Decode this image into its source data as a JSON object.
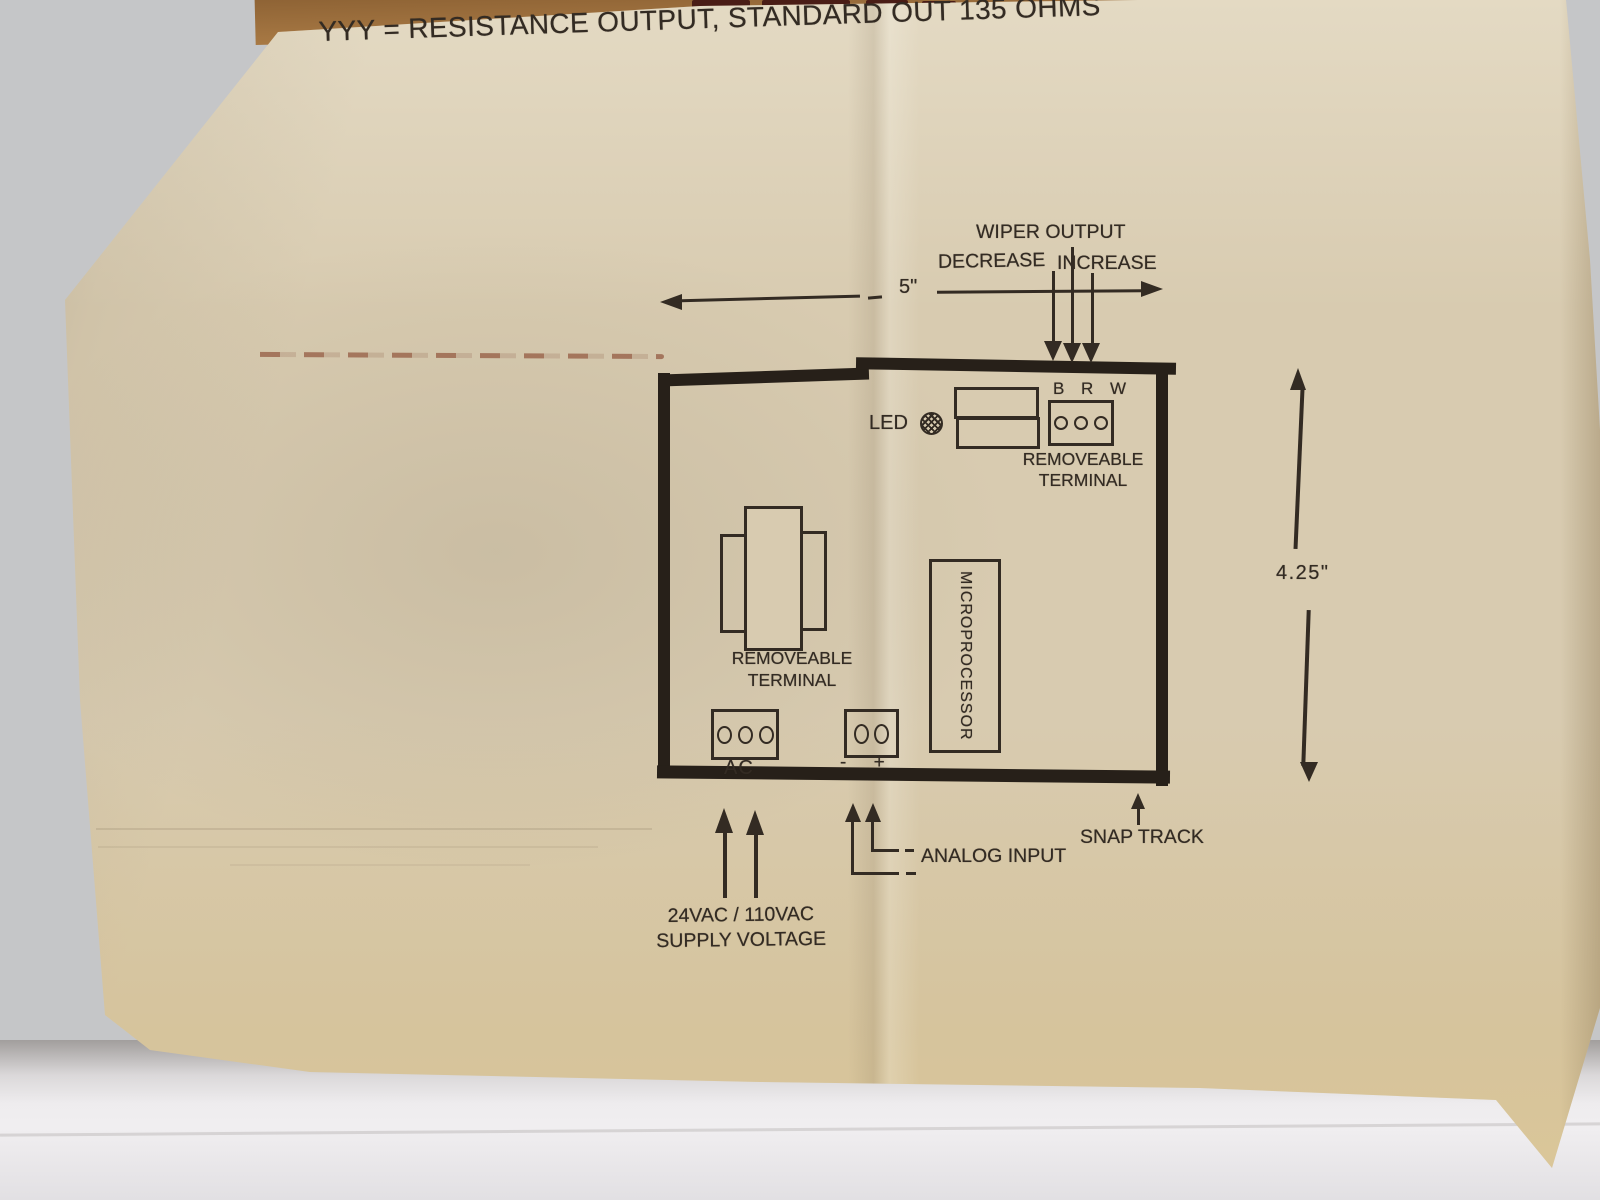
{
  "colors": {
    "ink": "#332b23",
    "ink_heavy": "#272019",
    "paper": "#d8cbb0",
    "cardboard": "#a87944",
    "background": "#c5c6c8",
    "table": "#eae8ea",
    "stain": "#8a4a32"
  },
  "header": {
    "title": "YYY = RESISTANCE OUTPUT, STANDARD OUT 135 OHMS"
  },
  "dimensions": {
    "board_width": "5\"",
    "board_height": "4.25\""
  },
  "board": {
    "led_label": "LED",
    "top_terminal": {
      "pin_labels": "B R W",
      "caption_line1": "REMOVEABLE",
      "caption_line2": "TERMINAL"
    },
    "microprocessor_label": "MICROPROCESSOR",
    "bottom_terminal": {
      "caption_line1": "REMOVEABLE",
      "caption_line2": "TERMINAL",
      "ac_label": "AC",
      "polarity_label": "- +"
    }
  },
  "annotations": {
    "wiper_output": "WIPER OUTPUT",
    "decrease": "DECREASE",
    "increase": "INCREASE",
    "snap_track": "SNAP TRACK",
    "analog_input": "ANALOG INPUT",
    "supply_voltage_line1": "24VAC / 110VAC",
    "supply_voltage_line2": "SUPPLY VOLTAGE"
  }
}
